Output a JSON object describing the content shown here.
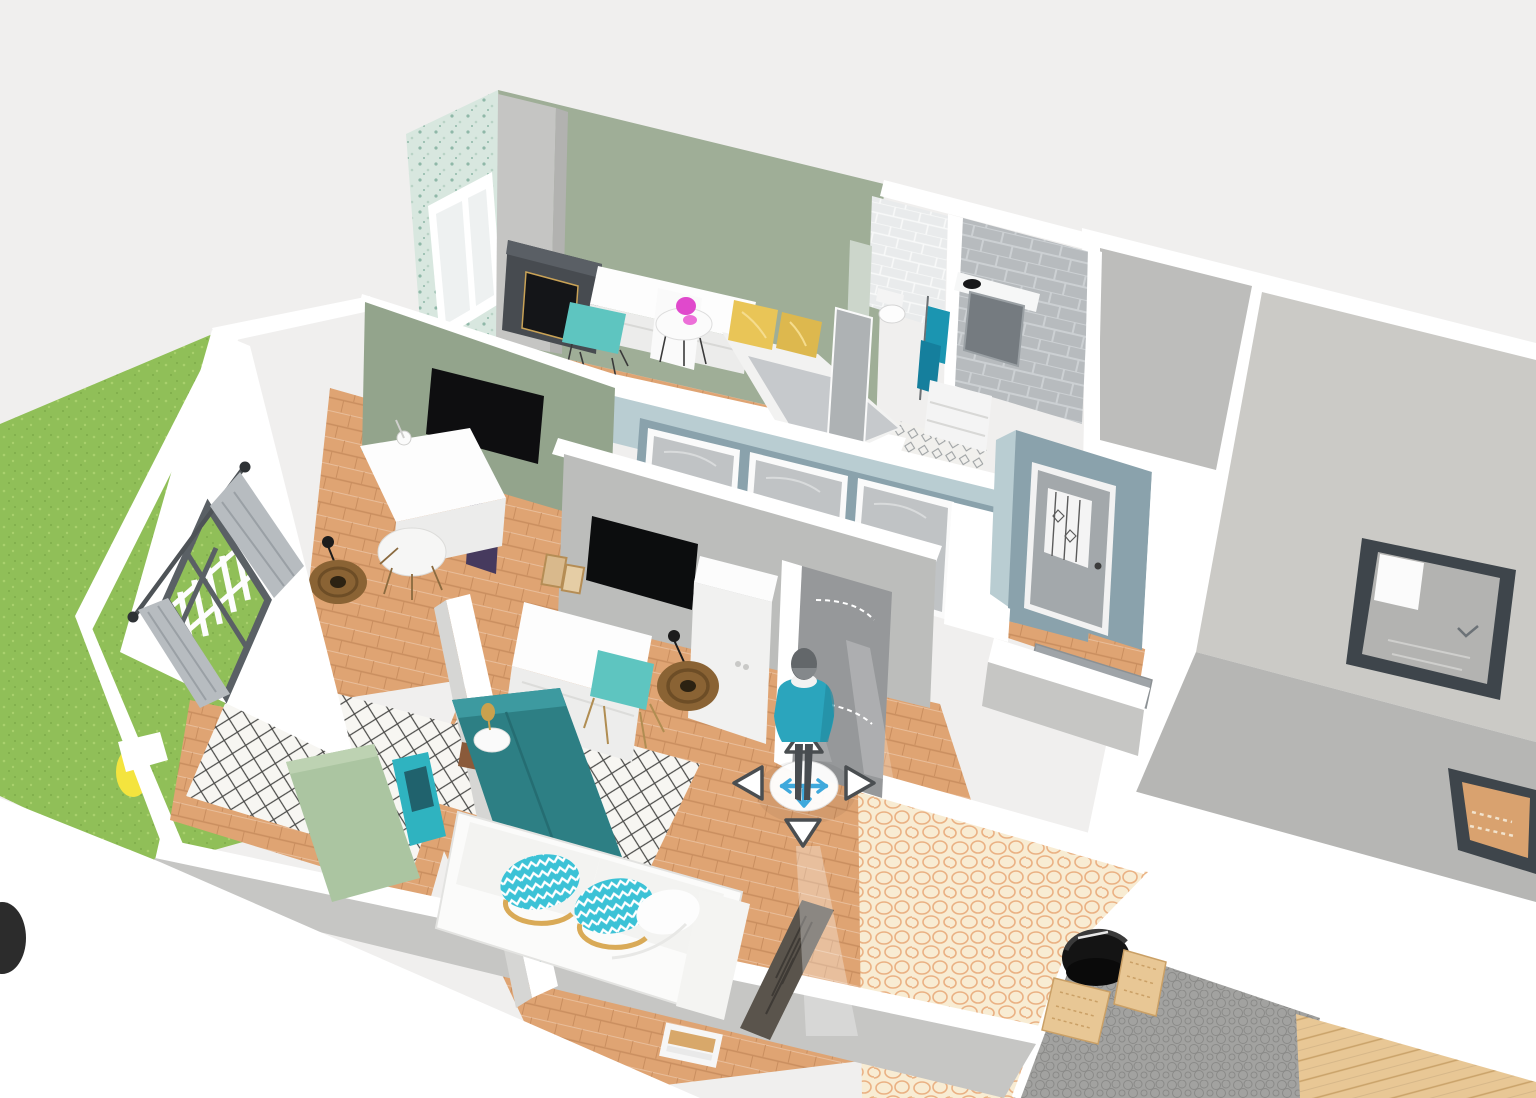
{
  "app": {
    "name": "3d-home-planner-viewport",
    "view": "aerial-dollhouse-3d",
    "visible_text": ""
  },
  "colors": {
    "bg": "#f0efee",
    "plate": "#ffffff",
    "wall-face": "#d6d6d4",
    "wall-face-dark": "#c6c6c4",
    "sage": "#9fae97",
    "sage-dark": "#93a48c",
    "pale-green": "#ccd6cb",
    "wallpaper": "#d8e7df",
    "wallpaper-dot": "#8fb8a8",
    "blue-wall": "#8aa2ac",
    "blue-light": "#b9cdd2",
    "gray-wall": "#bcbdbb",
    "wood": "#dfa473",
    "wood-dark": "#c98e5f",
    "rug-base": "#f7f6f2",
    "rug-line": "#4a4a48",
    "grass": "#90bf58",
    "grass-light": "#a8d06c",
    "grass-dark": "#7dab4a",
    "cobble-base": "#f8ecd3",
    "cobble-line": "#eab183",
    "pebble-base": "#a2a2a0",
    "pebble-line": "#8a8a88",
    "deck": "#e8c795",
    "deck-line": "#c9a269",
    "tile-gray": "#b7bbbe",
    "tile-grout": "#ccd0d3",
    "towel": "#1b95b1",
    "teal-chair": "#5ec5c0",
    "teal-wardrobe": "#2d7f84",
    "teal-wardrobe-light": "#3d9aa0",
    "chevron": "#3cc2d6",
    "headboard": "#abc5a1",
    "pillow-yellow": "#e9c557",
    "pillow-yellow2": "#ddb84e",
    "pink": "#e049cc",
    "accent-yellow": "#f4e43e",
    "radiator": "#5a544c",
    "fireplace": "#474b50",
    "firebox": "#141518",
    "roof-beige": "#cbcac6",
    "roof-gray": "#b6b6b4",
    "roof-gray2": "#bdbdbb",
    "skylight": "#3e454b",
    "door-gray": "#c0c3c5",
    "door-dark": "#96989a",
    "mat": "#9fa4a8",
    "shirt": "#2ba5bd",
    "pants": "#484c50",
    "head": "#63676a",
    "nav-blue": "#3fa9dc",
    "tri-border": "#4a4e51",
    "mirror": "#757b80",
    "rattan": "#8a6334",
    "rattan-dark": "#6d4d26",
    "purple": "#463a5e"
  },
  "nav_widget": {
    "person": "avatar-person-standing",
    "move_icon": "move-cross-icon",
    "arrows": [
      {
        "id": "up",
        "icon": "triangle-up-icon"
      },
      {
        "id": "left",
        "icon": "triangle-left-icon"
      },
      {
        "id": "right",
        "icon": "triangle-right-icon"
      },
      {
        "id": "down",
        "icon": "triangle-down-icon"
      }
    ]
  },
  "scene": {
    "rooms": [
      {
        "id": "top-bedroom",
        "wall": "sage-green-with-floral-wallpaper",
        "floor": "wood",
        "furniture": [
          "fireplace",
          "white-dresser",
          "teal-chair",
          "round-side-table",
          "pink-lamp",
          "bed-yellow-pillows",
          "double-window"
        ]
      },
      {
        "id": "bathroom",
        "wall": "gray-tiles",
        "floor": "patterned-tile",
        "furniture": [
          "mirror",
          "counter-basin",
          "vanity-cabinet",
          "teal-towels"
        ]
      },
      {
        "id": "toilet-room",
        "wall": "white-tiles",
        "furniture": [
          "toilet"
        ]
      },
      {
        "id": "study",
        "wall": "sage-green",
        "floor": "wood",
        "furniture": [
          "wall-tv",
          "white-desk",
          "white-chair",
          "rattan-pendant",
          "curtained-window",
          "purple-bench"
        ]
      },
      {
        "id": "center-bedroom",
        "wall": "gray",
        "floor": "wood-with-trellis-rug",
        "furniture": [
          "wall-tv",
          "white-wardrobe",
          "desk-bed",
          "teal-chair",
          "rattan-pendant",
          "picture-frames",
          "open-door"
        ]
      },
      {
        "id": "left-bedroom",
        "wall": "white",
        "floor": "wood-with-trellis-rug",
        "furniture": [
          "green-headboard-bed",
          "teal-tall-wardrobe",
          "side-table-lamp"
        ]
      },
      {
        "id": "living",
        "floor": "wood",
        "furniture": [
          "white-sofa-chevron-pillows",
          "radiator"
        ]
      },
      {
        "id": "hallway",
        "wall": "blue-gray",
        "doors": 3
      },
      {
        "id": "entrance-hall",
        "wall": "blue-gray",
        "furniture": [
          "glazed-front-door",
          "doormat"
        ]
      }
    ],
    "outdoor": [
      {
        "id": "garden",
        "items": [
          "grass",
          "white-picket-fence",
          "yellow-chair"
        ]
      },
      {
        "id": "stone-patio",
        "surface": "cream-cobblestone"
      },
      {
        "id": "gravel-patio",
        "surface": "gray-pebble",
        "items": [
          "black-fire-pit",
          "wood-crate-seats"
        ]
      },
      {
        "id": "deck",
        "surface": "wood-planks"
      },
      {
        "id": "roof-wing",
        "items": [
          "skylight-window-bed-view",
          "skylight-window-wood-view"
        ]
      }
    ]
  }
}
